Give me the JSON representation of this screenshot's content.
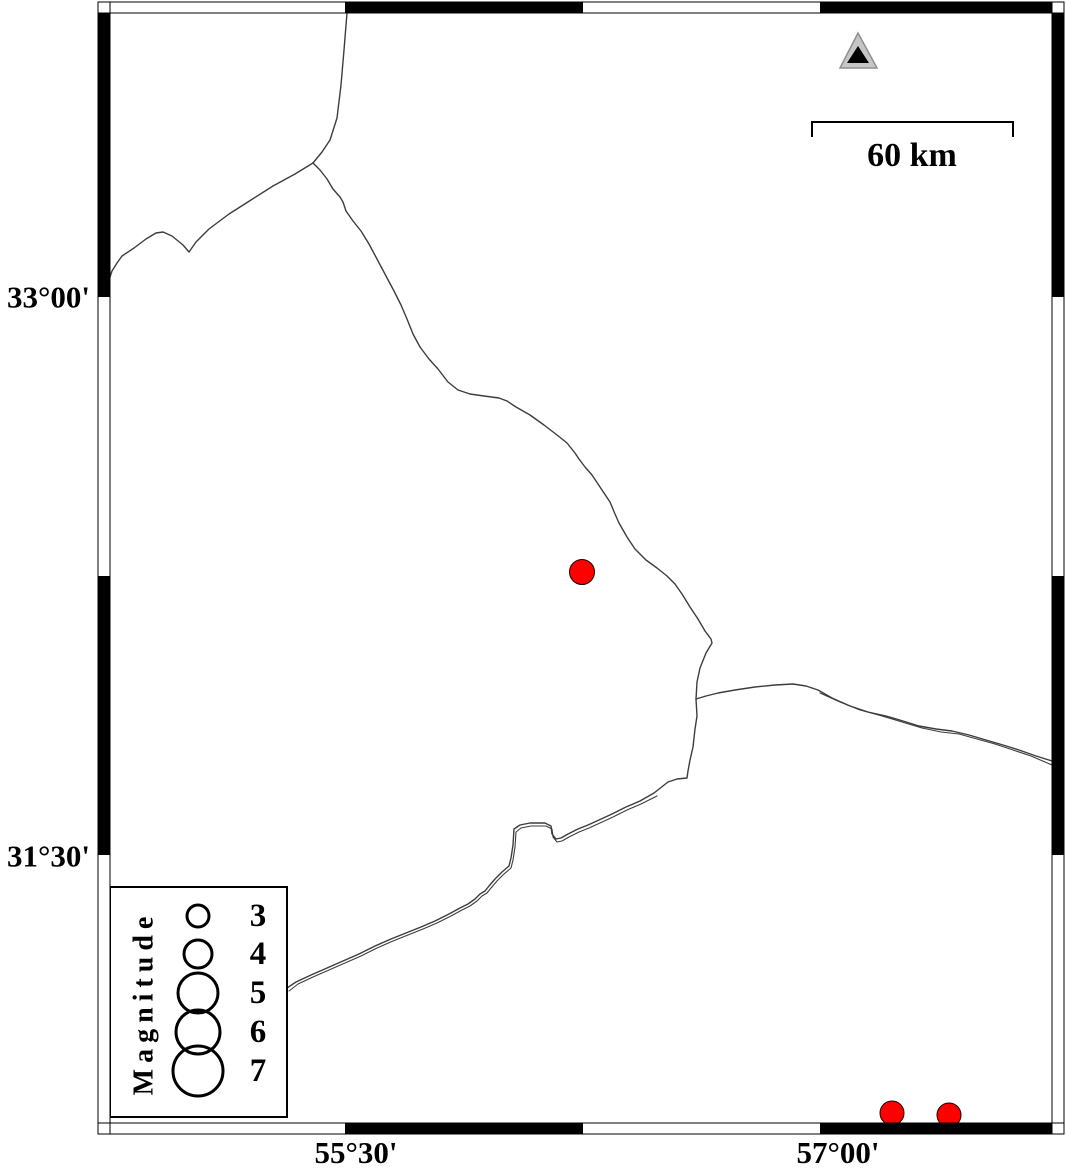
{
  "map": {
    "kind": "seismicity-epicenter-map",
    "colors": {
      "background": "#ffffff",
      "map_line": "#3d3d3d",
      "frame_black": "#000000",
      "frame_white": "#ffffff",
      "epicenter_fill": "#ff0000",
      "epicenter_stroke": "#1a0000",
      "station_outer_fill": "#c6c6c6",
      "station_outer_stroke": "#8f8f8f",
      "station_inner_fill": "#000000",
      "text": "#000000"
    },
    "frame": {
      "outer_x": 98,
      "outer_y": 2,
      "outer_w": 966,
      "outer_h": 1132,
      "band": 11,
      "corner_w": 12,
      "interior": {
        "x": 110,
        "y": 13,
        "w": 942,
        "h": 1110
      },
      "top_black_segments": [
        [
          345,
          583
        ],
        [
          820,
          1052
        ]
      ],
      "bottom_black_segments": [
        [
          345,
          583
        ],
        [
          820,
          1052
        ]
      ],
      "left_black_segments": [
        [
          13,
          297
        ],
        [
          576,
          855
        ]
      ],
      "right_black_segments": [
        [
          13,
          297
        ],
        [
          576,
          855
        ]
      ]
    },
    "axes": {
      "left_labels": [
        {
          "text": "33°00'",
          "x": 90,
          "y": 297
        },
        {
          "text": "31°30'",
          "x": 90,
          "y": 856
        }
      ],
      "bottom_labels": [
        {
          "text": "55°30'",
          "x": 356,
          "y": 1163
        },
        {
          "text": "57°00'",
          "x": 838,
          "y": 1163
        }
      ]
    },
    "scalebar": {
      "x1": 812,
      "x2": 1013,
      "y": 122,
      "tick_drop": 15,
      "label": "60 km",
      "label_x": 912,
      "label_y": 166
    },
    "station": {
      "outer": [
        [
          858,
          33
        ],
        [
          840,
          68
        ],
        [
          877,
          68
        ]
      ],
      "inner": [
        [
          858,
          46
        ],
        [
          847,
          63
        ],
        [
          869,
          63
        ]
      ]
    },
    "epicenters": [
      {
        "cx": 582,
        "cy": 572,
        "r": 12.5
      },
      {
        "cx": 892,
        "cy": 1113,
        "r": 12
      },
      {
        "cx": 949,
        "cy": 1115,
        "r": 12
      }
    ],
    "legend": {
      "x": 110,
      "y": 887,
      "w": 177,
      "h": 230,
      "title": "Magnitude",
      "title_x": 144,
      "title_y": 1003,
      "circle_cx": 198,
      "label_x": 258,
      "items": [
        {
          "label": "3",
          "cy": 916,
          "r": 11
        },
        {
          "label": "4",
          "cy": 954,
          "r": 14
        },
        {
          "label": "5",
          "cy": 993,
          "r": 20
        },
        {
          "label": "6",
          "cy": 1032,
          "r": 22
        },
        {
          "label": "7",
          "cy": 1071,
          "r": 25
        }
      ]
    },
    "lines": [
      {
        "name": "border-line-north",
        "w": 1.4,
        "points": [
          [
            347,
            13
          ],
          [
            344,
            50
          ],
          [
            341,
            85
          ],
          [
            337,
            118
          ],
          [
            330,
            140
          ],
          [
            322,
            152
          ],
          [
            313,
            163
          ]
        ]
      },
      {
        "name": "border-line-northwest",
        "w": 1.4,
        "points": [
          [
            313,
            163
          ],
          [
            295,
            174
          ],
          [
            273,
            186
          ],
          [
            251,
            200
          ],
          [
            229,
            214
          ],
          [
            209,
            229
          ],
          [
            196,
            242
          ],
          [
            189,
            252
          ],
          [
            183,
            245
          ],
          [
            172,
            236
          ],
          [
            163,
            232
          ],
          [
            156,
            233
          ],
          [
            146,
            239
          ],
          [
            134,
            248
          ],
          [
            122,
            256
          ],
          [
            117,
            263
          ],
          [
            112,
            271
          ],
          [
            110,
            277
          ]
        ]
      },
      {
        "name": "border-line-main-diagonal",
        "w": 1.4,
        "points": [
          [
            313,
            163
          ],
          [
            320,
            170
          ],
          [
            327,
            179
          ],
          [
            333,
            189
          ],
          [
            340,
            197
          ],
          [
            343,
            202
          ],
          [
            346,
            211
          ],
          [
            353,
            221
          ],
          [
            361,
            231
          ],
          [
            369,
            244
          ],
          [
            377,
            259
          ],
          [
            386,
            276
          ],
          [
            394,
            291
          ],
          [
            401,
            305
          ],
          [
            407,
            319
          ],
          [
            413,
            334
          ],
          [
            420,
            347
          ],
          [
            429,
            359
          ],
          [
            438,
            369
          ],
          [
            448,
            382
          ],
          [
            458,
            390
          ],
          [
            470,
            394
          ],
          [
            484,
            396
          ],
          [
            499,
            398
          ],
          [
            507,
            401
          ],
          [
            516,
            407
          ],
          [
            530,
            415
          ],
          [
            544,
            425
          ],
          [
            557,
            435
          ],
          [
            567,
            443
          ],
          [
            575,
            453
          ],
          [
            579,
            459
          ],
          [
            585,
            467
          ],
          [
            592,
            475
          ],
          [
            598,
            484
          ],
          [
            604,
            493
          ],
          [
            610,
            502
          ],
          [
            615,
            514
          ],
          [
            619,
            523
          ],
          [
            627,
            537
          ],
          [
            635,
            549
          ],
          [
            646,
            560
          ],
          [
            657,
            568
          ],
          [
            667,
            576
          ],
          [
            675,
            584
          ],
          [
            682,
            594
          ],
          [
            690,
            607
          ],
          [
            698,
            619
          ],
          [
            705,
            631
          ],
          [
            711,
            639
          ],
          [
            712,
            643
          ],
          [
            706,
            653
          ],
          [
            700,
            668
          ],
          [
            697,
            682
          ],
          [
            696,
            699
          ],
          [
            697,
            716
          ],
          [
            695,
            729
          ],
          [
            693,
            747
          ],
          [
            690,
            760
          ],
          [
            688,
            771
          ],
          [
            687,
            778
          ],
          [
            677,
            779
          ],
          [
            668,
            782
          ],
          [
            654,
            793
          ],
          [
            640,
            801
          ],
          [
            626,
            807
          ],
          [
            612,
            814
          ],
          [
            599,
            820
          ],
          [
            588,
            825
          ],
          [
            578,
            829
          ],
          [
            568,
            834
          ],
          [
            561,
            838
          ],
          [
            556,
            839
          ],
          [
            552,
            834
          ],
          [
            551,
            826
          ],
          [
            545,
            823
          ],
          [
            530,
            823
          ],
          [
            520,
            825
          ],
          [
            514,
            829
          ],
          [
            513,
            845
          ],
          [
            511,
            858
          ],
          [
            509,
            866
          ],
          [
            502,
            872
          ],
          [
            495,
            879
          ],
          [
            489,
            886
          ],
          [
            485,
            891
          ],
          [
            480,
            894
          ],
          [
            475,
            899
          ],
          [
            468,
            904
          ],
          [
            460,
            908
          ],
          [
            449,
            914
          ],
          [
            435,
            921
          ],
          [
            421,
            927
          ],
          [
            406,
            933
          ],
          [
            391,
            939
          ],
          [
            375,
            946
          ],
          [
            359,
            954
          ],
          [
            343,
            961
          ],
          [
            327,
            968
          ],
          [
            311,
            975
          ],
          [
            296,
            982
          ],
          [
            287,
            988
          ]
        ]
      },
      {
        "name": "border-line-southwest-parallel",
        "w": 1.1,
        "points": [
          [
            657,
            796
          ],
          [
            641,
            804
          ],
          [
            627,
            810
          ],
          [
            613,
            817
          ],
          [
            600,
            823
          ],
          [
            589,
            828
          ],
          [
            579,
            832
          ],
          [
            569,
            837
          ],
          [
            562,
            841
          ],
          [
            557,
            842
          ],
          [
            553,
            837
          ],
          [
            552,
            829
          ],
          [
            546,
            826
          ],
          [
            531,
            826
          ],
          [
            521,
            828
          ],
          [
            516,
            832
          ],
          [
            515,
            847
          ],
          [
            513,
            860
          ],
          [
            511,
            868
          ],
          [
            504,
            874
          ],
          [
            497,
            881
          ],
          [
            491,
            888
          ],
          [
            487,
            893
          ],
          [
            482,
            896
          ],
          [
            477,
            901
          ],
          [
            470,
            906
          ],
          [
            462,
            910
          ],
          [
            451,
            916
          ],
          [
            437,
            923
          ],
          [
            423,
            929
          ],
          [
            408,
            935
          ],
          [
            393,
            941
          ],
          [
            377,
            948
          ],
          [
            361,
            956
          ],
          [
            345,
            963
          ],
          [
            329,
            970
          ],
          [
            313,
            977
          ],
          [
            298,
            984
          ],
          [
            289,
            991
          ]
        ]
      },
      {
        "name": "border-line-east",
        "w": 1.4,
        "points": [
          [
            696,
            699
          ],
          [
            706,
            696
          ],
          [
            718,
            693
          ],
          [
            735,
            690
          ],
          [
            755,
            687
          ],
          [
            775,
            685
          ],
          [
            793,
            684
          ],
          [
            806,
            686
          ],
          [
            818,
            690
          ],
          [
            832,
            698
          ],
          [
            850,
            706
          ],
          [
            868,
            712
          ],
          [
            886,
            716
          ],
          [
            903,
            721
          ],
          [
            919,
            726
          ],
          [
            936,
            729
          ],
          [
            952,
            731
          ],
          [
            969,
            735
          ],
          [
            986,
            740
          ],
          [
            1003,
            745
          ],
          [
            1019,
            750
          ],
          [
            1036,
            756
          ],
          [
            1052,
            761
          ]
        ]
      },
      {
        "name": "border-line-east-parallel",
        "w": 1.1,
        "points": [
          [
            820,
            693
          ],
          [
            840,
            702
          ],
          [
            860,
            710
          ],
          [
            882,
            716
          ],
          [
            902,
            722
          ],
          [
            922,
            728
          ],
          [
            941,
            732
          ],
          [
            959,
            734
          ],
          [
            977,
            739
          ],
          [
            995,
            744
          ],
          [
            1013,
            750
          ],
          [
            1031,
            756
          ],
          [
            1052,
            765
          ]
        ]
      }
    ]
  }
}
